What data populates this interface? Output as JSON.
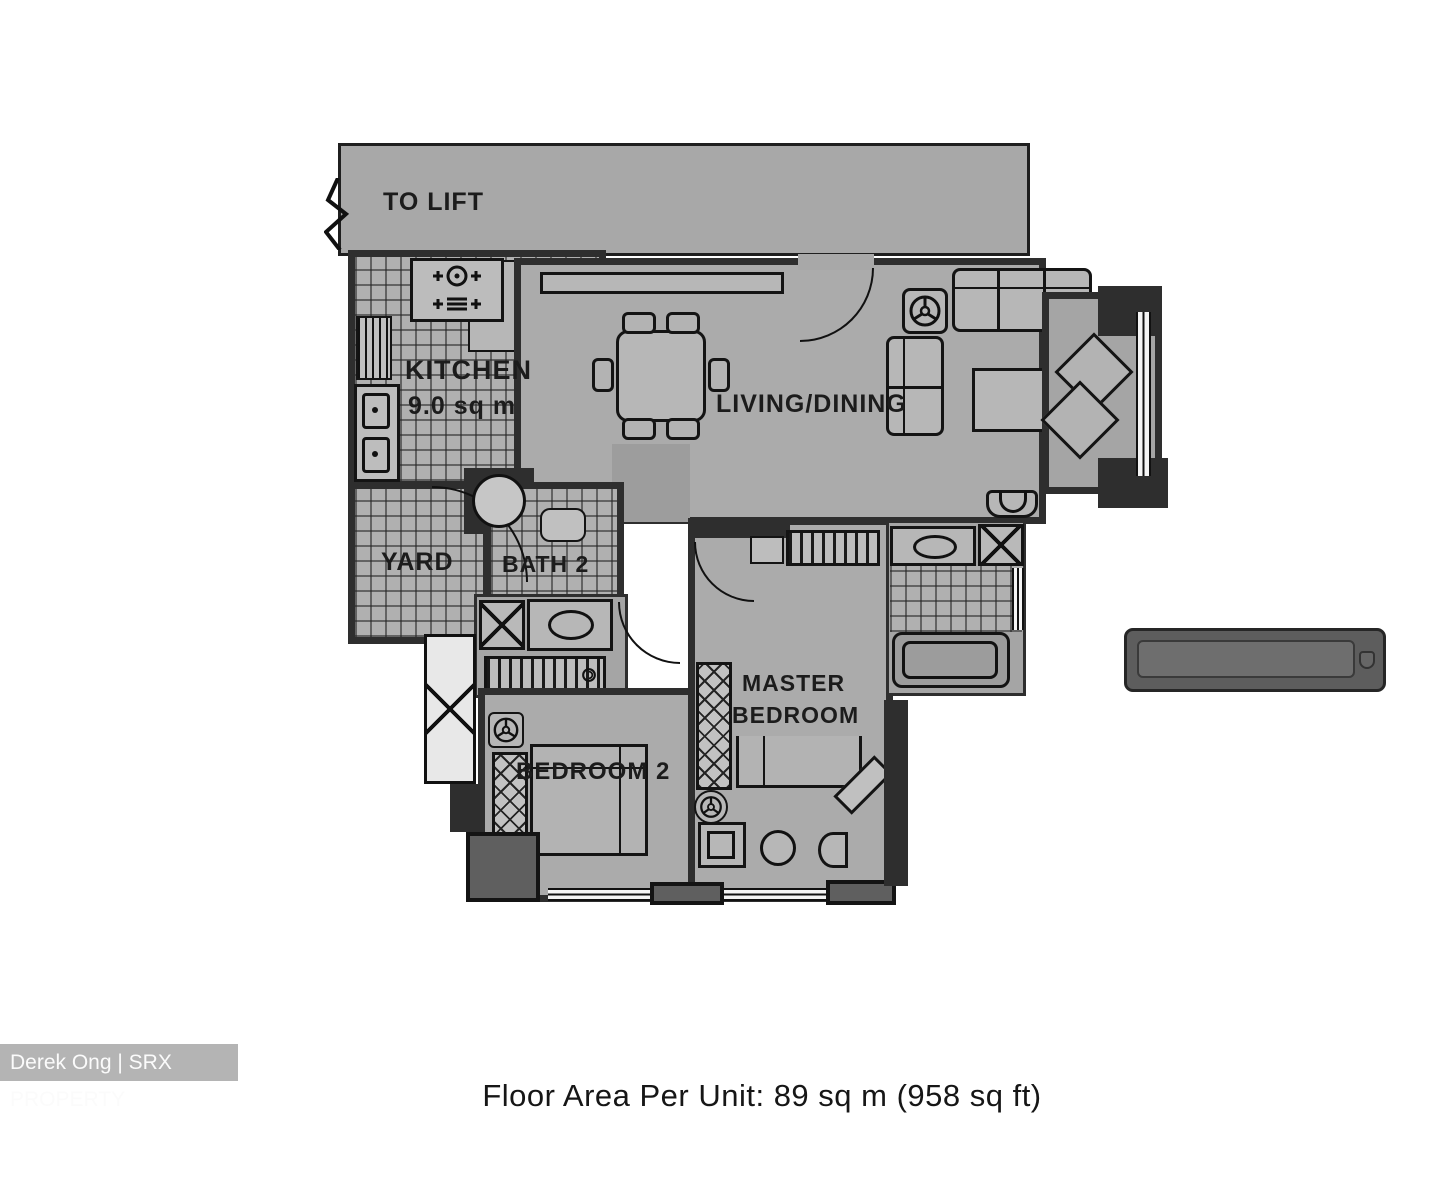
{
  "caption": "Floor Area Per Unit: 89 sq m (958 sq ft)",
  "watermark": "Derek Ong | SRX PROPERTY",
  "rooms": {
    "corridor_label": "TO LIFT",
    "kitchen_label": "KITCHEN",
    "kitchen_area": "9.0 sq m",
    "living_dining_label": "LIVING/DINING",
    "yard_label": "YARD",
    "bath2_label": "BATH 2",
    "master_bedroom_line1": "MASTER",
    "master_bedroom_line2": "BEDROOM",
    "bedroom2_label": "BEDROOM 2"
  },
  "colors": {
    "page_bg": "#ffffff",
    "floor": "#ababab",
    "wall": "#2e2e2e",
    "corridor": "#a8a8a8",
    "watermark_bg": "#b4b4b4",
    "watermark_text": "#fbfbfb"
  }
}
